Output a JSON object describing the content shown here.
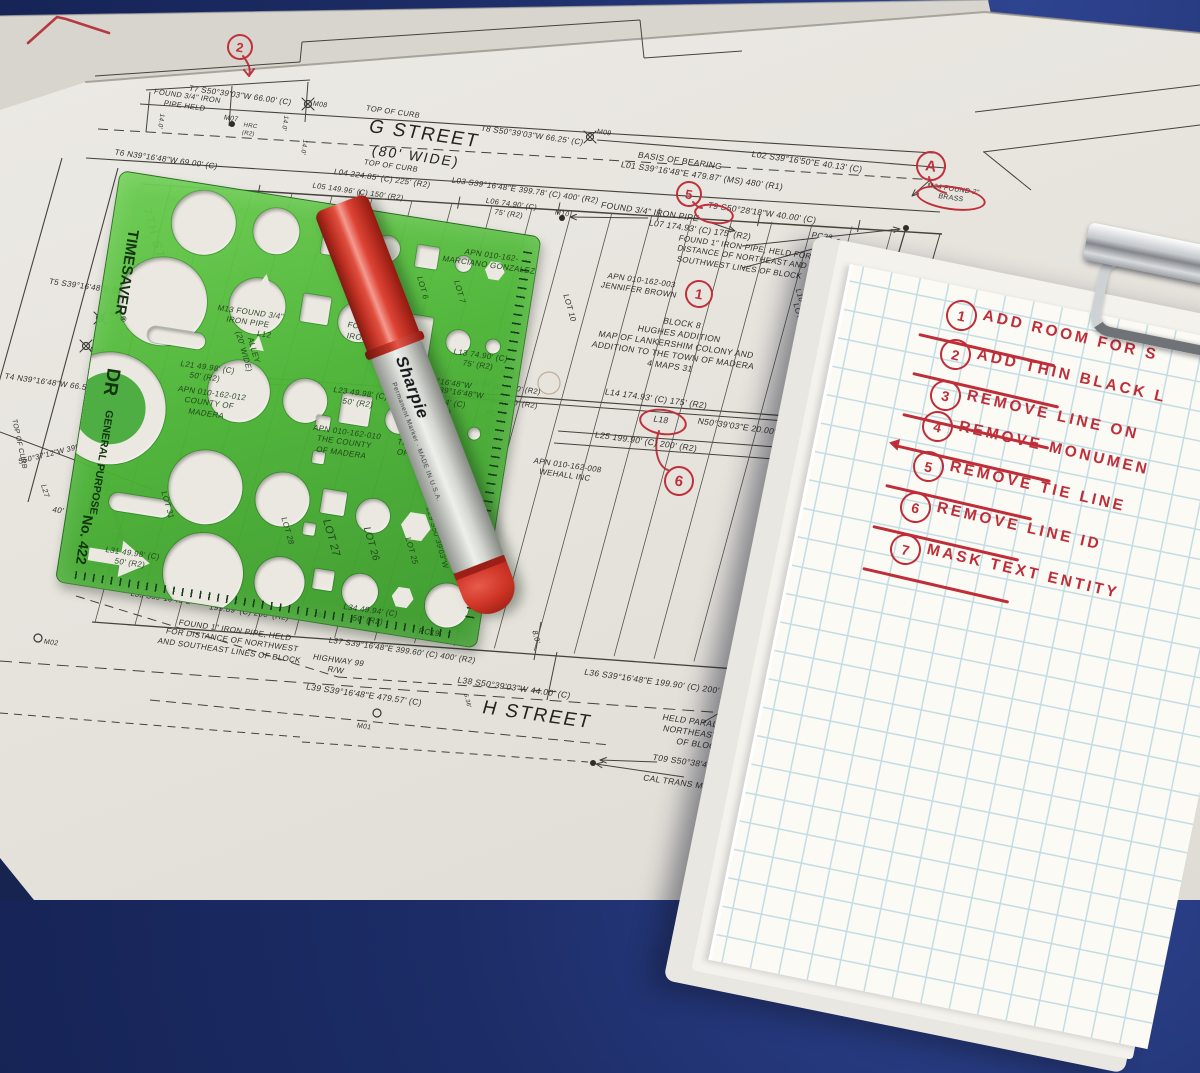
{
  "surveyor": {
    "title": "SURVEYOR'",
    "lines": [
      "THIS MAP CORRECT",
      "ME OR UNDER MY D",
      "THE REQUIREMENT",
      "SURVEYORS' ACT I"
    ],
    "signer": "ALEX CALDER, P.L"
  },
  "legend": {
    "title": "LEGEND",
    "items": [
      {
        "sym": "⊕",
        "text": "INDICATES SET NAIL TAGGED L.S.\n8863"
      },
      {
        "sym": "○",
        "text": "INDICATES SET 1\" I.P. TAGGED L.S.\n8863"
      },
      {
        "sym": "●",
        "text": "INDICATES FOUND MONUMENT AS\nNOTED"
      },
      {
        "sym": "C",
        "text": "CALCULATED"
      },
      {
        "sym": "HRC",
        "text": "HELD RECORD"
      },
      {
        "sym": "M",
        "text": "MO"
      }
    ]
  },
  "references": {
    "title": "REFERENCES",
    "items": [
      "R1)  37 M 53",
      "R2)  4 M 31",
      "R3)  DN 2012032672",
      "R4)  DN 2014013362",
      "R5)  DN 20140133"
    ]
  },
  "units": {
    "title": "UNITS",
    "note": "UNLESS OTHE"
  },
  "template_tool": {
    "brand": "TIMESAVER",
    "reg": "®",
    "line2": "DR",
    "line3": "GENERAL PURPOSE",
    "model": "No. 422"
  },
  "marker": {
    "brand": "Sharpie",
    "sub": "Permanent Marker · MADE IN U.S.A."
  },
  "clipboard": {
    "notes": [
      {
        "num": "1",
        "text": "ADD ROOM FOR S"
      },
      {
        "num": "2",
        "text": "ADD THIN BLACK L"
      },
      {
        "num": "3",
        "text": "REMOVE LINE ON"
      },
      {
        "num": "4",
        "text": "REMOVE MONUMEN",
        "arrow": true
      },
      {
        "num": "5",
        "text": "REMOVE TIE LINE"
      },
      {
        "num": "6",
        "text": "REMOVE LINE ID"
      },
      {
        "num": "7",
        "text": "MASK TEXT ENTITY"
      }
    ]
  },
  "map": {
    "red_circles": [
      {
        "l": "2",
        "x": 238,
        "y": 45,
        "r": 11
      },
      {
        "l": "A",
        "x": 929,
        "y": 164,
        "r": 13
      },
      {
        "l": "5",
        "x": 687,
        "y": 192,
        "r": 11
      },
      {
        "l": "1",
        "x": 697,
        "y": 292,
        "r": 12
      },
      {
        "l": "6",
        "x": 677,
        "y": 479,
        "r": 13
      }
    ],
    "red_ellipses": [
      {
        "x": 712,
        "y": 212,
        "w": 36,
        "h": 16
      },
      {
        "x": 661,
        "y": 420,
        "w": 44,
        "h": 22
      },
      {
        "x": 949,
        "y": 196,
        "w": 66,
        "h": 20
      }
    ],
    "annotations": [
      {
        "t": "T7 S50°39'03\"W  66.00' (C)",
        "x": 240,
        "y": 96
      },
      {
        "t": "FOUND 3/4\" IRON\nPIPE HELD",
        "x": 186,
        "y": 101,
        "s": 7.5
      },
      {
        "t": "M07",
        "x": 231,
        "y": 119,
        "s": 7
      },
      {
        "t": "HRC\n(R2)",
        "x": 249,
        "y": 131,
        "s": 6
      },
      {
        "t": "M08",
        "x": 320,
        "y": 105,
        "s": 7
      },
      {
        "t": "14.0'",
        "x": 160,
        "y": 121,
        "r": 98,
        "s": 6.5
      },
      {
        "t": "14.0'",
        "x": 284,
        "y": 123,
        "r": 98,
        "s": 6.5
      },
      {
        "t": "14.0'",
        "x": 303,
        "y": 147,
        "r": 98,
        "s": 6.5
      },
      {
        "t": "TOP OF CURB",
        "x": 393,
        "y": 112,
        "s": 7.5
      },
      {
        "t": "G STREET",
        "x": 424,
        "y": 135,
        "s": 19,
        "c": "street"
      },
      {
        "t": "(80' WIDE)",
        "x": 416,
        "y": 156,
        "s": 14,
        "c": "street"
      },
      {
        "t": "T8 S50°39'03\"W  66.25' (C)",
        "x": 532,
        "y": 136
      },
      {
        "t": "M09",
        "x": 604,
        "y": 133,
        "s": 7
      },
      {
        "t": "TOP OF CURB",
        "x": 391,
        "y": 166,
        "s": 7.5
      },
      {
        "t": "L04 224.85' (C) 225' (R2)",
        "x": 382,
        "y": 179
      },
      {
        "t": "L05 149.96' (C) 150' (R2)",
        "x": 358,
        "y": 192,
        "s": 7.5
      },
      {
        "t": "L03 S39°16'48\"E  399.78' (C) 400' (R2)",
        "x": 525,
        "y": 191
      },
      {
        "t": "BASIS OF BEARING",
        "x": 680,
        "y": 161,
        "s": 8.5
      },
      {
        "t": "L01 S39°16'48\"E  479.87' (MS) 480' (R1)",
        "x": 702,
        "y": 176,
        "s": 8.5
      },
      {
        "t": "L02 S39°16'50\"E  40.13' (C)",
        "x": 807,
        "y": 162,
        "s": 8.5
      },
      {
        "t": "L06 74.90' (C)\n75' (R2)",
        "x": 510,
        "y": 209,
        "s": 7.5
      },
      {
        "t": "M10",
        "x": 562,
        "y": 214,
        "s": 7
      },
      {
        "t": "FOUND 3/4\" IRON PIPE",
        "x": 650,
        "y": 212,
        "s": 8.5
      },
      {
        "t": "T9  S50°28'18\"W  40.00' (C)",
        "x": 762,
        "y": 213,
        "s": 8.5
      },
      {
        "t": "L07 174.93' (C) 175' (R2)",
        "x": 700,
        "y": 230,
        "s": 8.5
      },
      {
        "t": "PC23",
        "x": 822,
        "y": 237
      },
      {
        "t": "FOUND 1\" IRON PIPE, HELD FOR\nDISTANCE OF NORTHEAST AND\nSOUTHWEST LINES OF BLOCK",
        "x": 742,
        "y": 258
      },
      {
        "t": "M24 FOUND 2\"\nBRASS",
        "x": 952,
        "y": 194,
        "s": 7
      },
      {
        "t": "40'",
        "x": 869,
        "y": 289,
        "s": 8.5
      },
      {
        "t": "APN 010-162-003\nJENNIFER BROWN",
        "x": 640,
        "y": 286
      },
      {
        "t": "LOT 10",
        "x": 569,
        "y": 308,
        "r": 74
      },
      {
        "t": "LOT 16",
        "x": 799,
        "y": 317,
        "r": 74
      },
      {
        "t": "L10 S50°39'03\"W  150.00' (R2)",
        "x": 813,
        "y": 342,
        "r": 74,
        "s": 7.5
      },
      {
        "t": "BLOCK 8\nHUGHES ADDITION\nMAP OF LANKERSHIM COLONY AND\nADDITION TO THE TOWN OF MADERA\n4 MAPS 31",
        "x": 676,
        "y": 345,
        "s": 8.5
      },
      {
        "t": "L15 S50°39'03\"W  319.98' (R2)",
        "x": 829,
        "y": 434,
        "r": 74,
        "s": 7.5
      },
      {
        "t": "L14 174.93' (C) 175' (R2)",
        "x": 656,
        "y": 399,
        "s": 8.5
      },
      {
        "t": "L18",
        "x": 661,
        "y": 420,
        "s": 8.5
      },
      {
        "t": "N50°39'03\"E  20.00' (R2)",
        "x": 747,
        "y": 428,
        "s": 8.5
      },
      {
        "t": "L25 199.90' (C) 200' (R2)",
        "x": 646,
        "y": 442,
        "s": 8.5
      },
      {
        "t": "PC22",
        "x": 795,
        "y": 418
      },
      {
        "t": "PC21",
        "x": 789,
        "y": 464
      },
      {
        "t": "APN 010-162-008\nWEHALL INC",
        "x": 566,
        "y": 471
      },
      {
        "t": "LOT 17",
        "x": 761,
        "y": 601,
        "r": 74
      },
      {
        "t": "L30 S50°39'03\"W  150.00' (R2)",
        "x": 779,
        "y": 613,
        "r": 74,
        "s": 7.5
      },
      {
        "t": "STREET",
        "x": 875,
        "y": 349,
        "r": 74,
        "s": 13,
        "c": "street"
      },
      {
        "t": "T6 N39°16'48\"W  69.00' (C)",
        "x": 166,
        "y": 160
      },
      {
        "t": "7TH STREET",
        "x": 159,
        "y": 253,
        "r": 74,
        "s": 12,
        "c": "street"
      },
      {
        "t": "T5 S39°16'48\"E  66.50' (C)",
        "x": 99,
        "y": 289
      },
      {
        "t": "M05",
        "x": 117,
        "y": 315,
        "s": 7
      },
      {
        "t": "M04",
        "x": 97,
        "y": 351,
        "s": 7
      },
      {
        "t": "T4 N39°16'48\"W  66.50' (C)",
        "x": 56,
        "y": 384
      },
      {
        "t": "TOP OF CURB",
        "x": 19,
        "y": 444,
        "r": 78,
        "s": 7
      },
      {
        "t": "S50°37'12\"W  399.86' (C)",
        "x": 62,
        "y": 451,
        "r": -14,
        "s": 7.5
      },
      {
        "t": "40'",
        "x": 58,
        "y": 511
      },
      {
        "t": "L27",
        "x": 45,
        "y": 491,
        "r": 74,
        "s": 7.5
      },
      {
        "t": "M02",
        "x": 51,
        "y": 643,
        "s": 7
      },
      {
        "t": "L28 N50°39'03\"W",
        "x": 113,
        "y": 509,
        "r": 74,
        "s": 7.5
      },
      {
        "t": "LOT 31",
        "x": 167,
        "y": 505,
        "r": 74,
        "c": "ut"
      },
      {
        "t": "L31 49.98' (C)\n50' (R2)",
        "x": 131,
        "y": 559,
        "c": "ut"
      },
      {
        "t": "L33 S39°16'48\"E",
        "x": 161,
        "y": 598,
        "s": 7.5
      },
      {
        "t": "199.89' (C) 200' (R2)",
        "x": 249,
        "y": 613
      },
      {
        "t": "FOUND 1\" IRON PIPE, HELD\nFOR DISTANCE OF NORTHWEST\nAND SOUTHEAST LINES OF BLOCK",
        "x": 232,
        "y": 641
      },
      {
        "t": "L34 49.94' (C)\n50' (R2)",
        "x": 369,
        "y": 616,
        "c": "ut"
      },
      {
        "t": "PC19",
        "x": 429,
        "y": 633,
        "c": "ut"
      },
      {
        "t": "L37 S39°16'48\"E  399.60' (C) 400' (R2)",
        "x": 402,
        "y": 651
      },
      {
        "t": "HIGHWAY 99\nR/W",
        "x": 337,
        "y": 666
      },
      {
        "t": "L39 S39°16'48\"E  479.57' (C)",
        "x": 364,
        "y": 695,
        "s": 8.5
      },
      {
        "t": "M01",
        "x": 364,
        "y": 727,
        "s": 7
      },
      {
        "t": "L38 S50°39'03\"W  44.00' (C)",
        "x": 514,
        "y": 688,
        "s": 8.5
      },
      {
        "t": "8.0'",
        "x": 536,
        "y": 637,
        "r": 76,
        "s": 7.5
      },
      {
        "t": "5.36'",
        "x": 466,
        "y": 701,
        "r": 76,
        "s": 6
      },
      {
        "t": "H STREET",
        "x": 537,
        "y": 716,
        "s": 19,
        "c": "street"
      },
      {
        "t": "L36 S39°16'48\"E  199.90' (C) 200' (R2)",
        "x": 662,
        "y": 683,
        "s": 8.5
      },
      {
        "t": "HELD PARALLEL TO\nNORTHEAST SIDE\nOF BLOCK",
        "x": 702,
        "y": 734,
        "s": 8.5
      },
      {
        "t": "T09 S50°38'44\"W  4",
        "x": 692,
        "y": 763,
        "s": 8.5
      },
      {
        "t": "CAL TRANS MON - N",
        "x": 687,
        "y": 784,
        "s": 8.5
      },
      {
        "t": "LOT 5",
        "x": 389,
        "y": 277,
        "r": 74,
        "c": "ut"
      },
      {
        "t": "LOT 6",
        "x": 422,
        "y": 288,
        "r": 74,
        "c": "ut"
      },
      {
        "t": "LOT 7",
        "x": 459,
        "y": 292,
        "r": 74,
        "c": "ut"
      },
      {
        "t": "M16\nFOUND 3/4\"\nIRON PIPE",
        "x": 371,
        "y": 329,
        "c": "ut"
      },
      {
        "t": "ALLEY\n(20' WIDE)",
        "x": 248,
        "y": 351,
        "r": 74,
        "c": "ut"
      },
      {
        "t": "L21 49.98' (C)\n50' (R2)",
        "x": 206,
        "y": 373,
        "c": "ut"
      },
      {
        "t": "APN 010-162-012\nCOUNTY OF\nMADERA",
        "x": 209,
        "y": 404,
        "c": "ut"
      },
      {
        "t": "M13 FOUND 3/4\"\nIRON PIPE",
        "x": 249,
        "y": 318,
        "c": "ut"
      },
      {
        "t": "L12",
        "x": 264,
        "y": 335,
        "c": "ut"
      },
      {
        "t": "L23 49.98' (C)\n50' (R2)",
        "x": 359,
        "y": 399,
        "c": "ut"
      },
      {
        "t": "APN 010-162-010\nTHE COUNTY\nOF MADERA",
        "x": 344,
        "y": 443,
        "c": "ut"
      },
      {
        "t": "APN\n010-162-009\nTHE COUNTY\nOF MADERA",
        "x": 426,
        "y": 441,
        "c": "ut"
      },
      {
        "t": "L24 49.94' (C)\n50' (R2)",
        "x": 437,
        "y": 407,
        "c": "ut"
      },
      {
        "t": "L20 N39°16'48\"W",
        "x": 450,
        "y": 392,
        "c": "ut"
      },
      {
        "t": "L17 N39°16'48\"W",
        "x": 438,
        "y": 382,
        "c": "ut"
      },
      {
        "t": "399.78' (C) 400' (R2)",
        "x": 503,
        "y": 387,
        "s": 7.5
      },
      {
        "t": "399.78' (C) 400' (R2)",
        "x": 500,
        "y": 401,
        "s": 7.5
      },
      {
        "t": "PC17",
        "x": 510,
        "y": 374,
        "s": 7.5
      },
      {
        "t": "PC18",
        "x": 496,
        "y": 414,
        "s": 7.5
      },
      {
        "t": "L13 74.90' (C)\n75' (R2)",
        "x": 479,
        "y": 361,
        "c": "ut"
      },
      {
        "t": "APN 010-162-\nMARCIANO GONZALEZ",
        "x": 490,
        "y": 261,
        "c": "ut"
      },
      {
        "t": "LOT 28",
        "x": 287,
        "y": 531,
        "r": 74,
        "c": "ut"
      },
      {
        "t": "LOT 27",
        "x": 331,
        "y": 538,
        "r": 74,
        "s": 11,
        "c": "ut"
      },
      {
        "t": "LOT 26",
        "x": 371,
        "y": 544,
        "r": 74,
        "s": 10,
        "c": "ut"
      },
      {
        "t": "LOT 25",
        "x": 411,
        "y": 551,
        "r": 74,
        "c": "ut"
      },
      {
        "t": "LOT 24",
        "x": 454,
        "y": 562,
        "r": 74,
        "c": "ut"
      },
      {
        "t": "L29 S50°39'03\"W",
        "x": 437,
        "y": 538,
        "r": 74,
        "s": 7.5,
        "c": "ut"
      }
    ]
  }
}
